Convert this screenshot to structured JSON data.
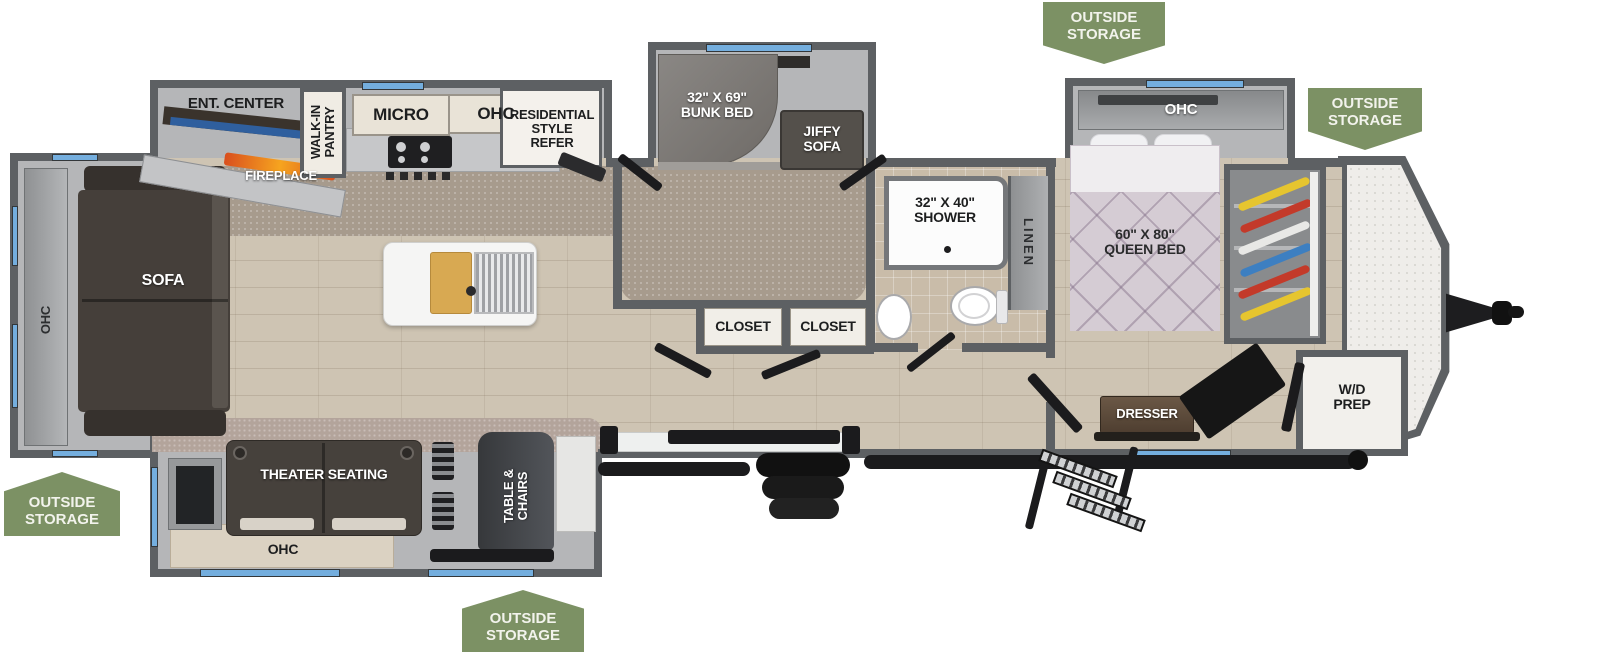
{
  "fp": {
    "badges": {
      "outside_storage": "OUTSIDE\nSTORAGE"
    },
    "rear": {
      "ohc": "OHC",
      "sofa": "SOFA"
    },
    "kitchen": {
      "ent_center": "ENT. CENTER",
      "fireplace": "FIREPLACE",
      "walk_in_pantry": "WALK-IN\nPANTRY",
      "micro": "MICRO",
      "ohc": "OHC",
      "refer": "RESIDENTIAL\nSTYLE\nREFER"
    },
    "bunk": {
      "bunk_bed": "32\" X 69\"\nBUNK BED",
      "jiffy_sofa": "JIFFY\nSOFA",
      "closet_left": "CLOSET",
      "closet_right": "CLOSET"
    },
    "bath": {
      "shower": "32\" X 40\"\nSHOWER",
      "linen": "LINEN"
    },
    "bedroom": {
      "ohc": "OHC",
      "queen_bed": "60\" X 80\"\nQUEEN BED",
      "dresser": "DRESSER",
      "wd_prep": "W/D\nPREP"
    },
    "living": {
      "theater_seating": "THEATER SEATING",
      "table_chairs": "TABLE &\nCHAIRS",
      "ohc": "OHC"
    },
    "colors": {
      "badge_green": "#7c9164",
      "wall_gray": "#5d6063",
      "slide_gray": "#b5b6b8",
      "window_blue": "#74aede",
      "wood_floor": "#cec4b3",
      "carpet": "#a79b8d",
      "furniture_dark": "#453f3a",
      "flame_orange": "#f07f23",
      "bed_quilt": "#d5ccd4",
      "hanger_colors": [
        "#e6c52f",
        "#c33a2a",
        "#e8e8e6",
        "#3d7fc1",
        "#c33a2a",
        "#e6c52f"
      ]
    }
  }
}
